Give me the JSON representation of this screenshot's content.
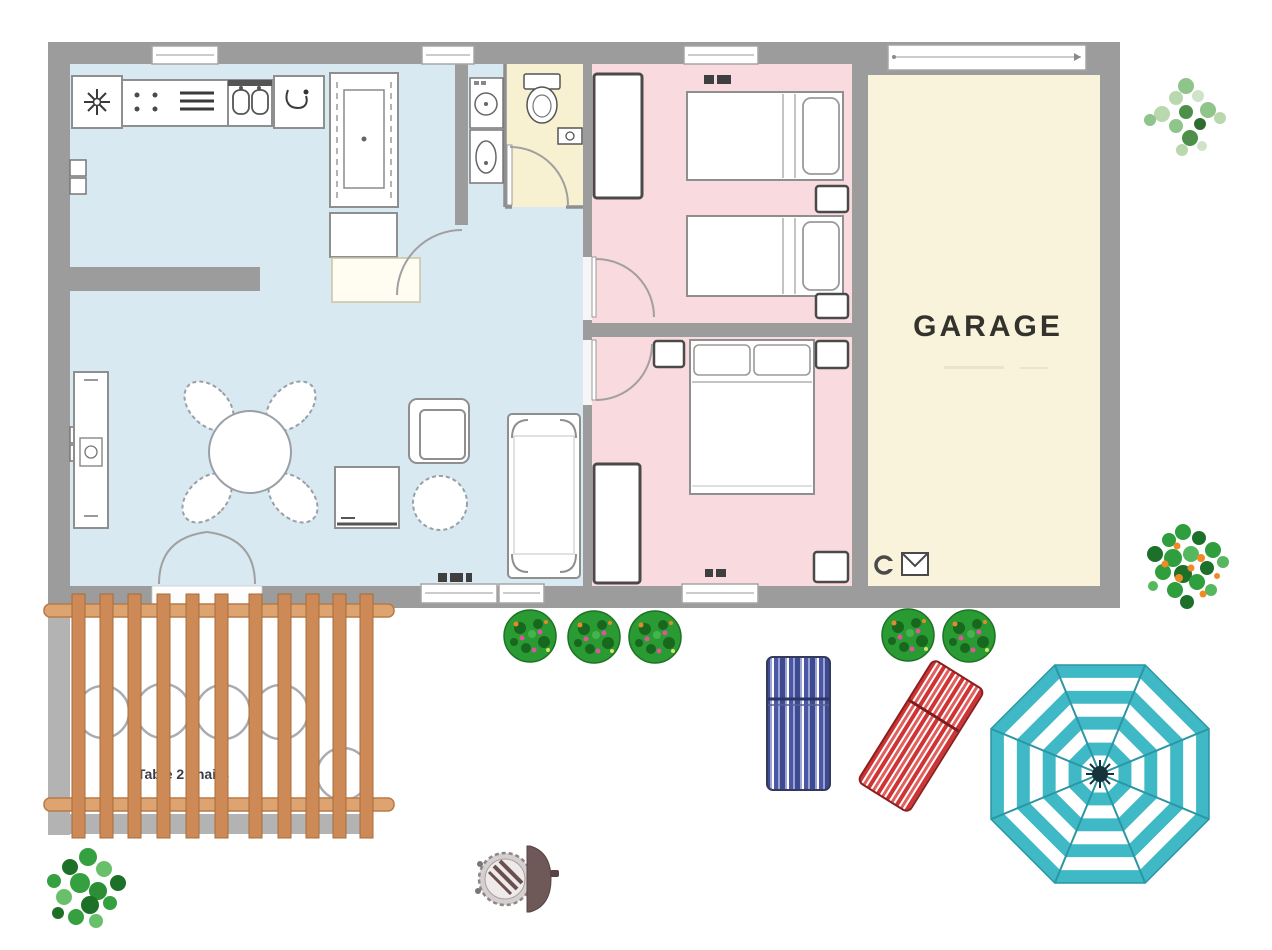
{
  "labels": {
    "garage": "GARAGE",
    "pergola_table": "Table 2 chairs"
  },
  "colors": {
    "wall": "#9c9c9c",
    "patio_wall": "#b3b3b3",
    "room_living": "#d9e9f1",
    "room_bathroom": "#f7f1d2",
    "room_bedroom": "#f9dade",
    "room_garage": "#f8f3da",
    "pergola_beam": "#dda371",
    "pergola_slat": "#cd8a57",
    "bush_green": "#2a9a33",
    "umbrella_teal": "#3fb9c5",
    "lounger_blue": "#3d4a8f",
    "lounger_red": "#cf3434",
    "tree_light_green": "#b9d8ae",
    "tree_fruit_green": "#2f9e3c",
    "fruit_orange": "#ef8a25",
    "furniture_outline": "#8f8f8f",
    "label_text": "#33322c"
  }
}
